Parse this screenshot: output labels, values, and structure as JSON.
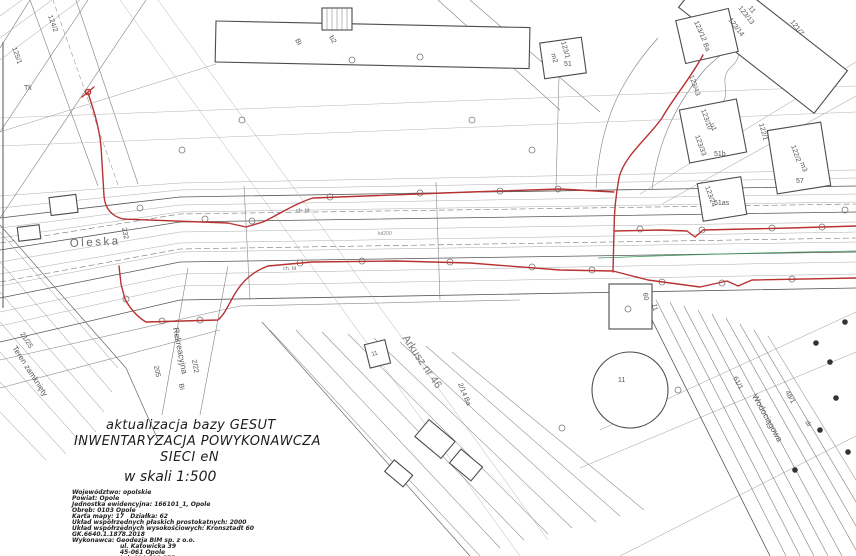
{
  "colors": {
    "red": "#b83232",
    "green": "#3f9960",
    "line_light": "#ababab",
    "line_mid": "#7d7d7d",
    "line_dark": "#4c4c4c",
    "text": "#555555"
  },
  "title_block": {
    "line1": "aktualizacja bazy GESUT",
    "line2": "INWENTARYZACJA POWYKONAWCZA",
    "line3": "SIECI eN",
    "scale": "w skali 1:500",
    "details": [
      "Województwo: opolskie",
      "Powiat: Opole",
      "Jednostka ewidencyjna: 166101_1, Opole",
      "Obręb: 0103 Opole",
      "Karta mapy: 17   Działka: 62",
      "Układ współrzędnych płaskich prostokątnych: 2000",
      "Układ współrzędnych wysokościowych: Kronsztadt 60",
      "GK.6640.1.1878.2018",
      "Wykonawca: Geodezja BIM sp. z o.o.",
      "ul. Katowicka 39",
      "45-061 Opole",
      "tel. 604 090 875"
    ]
  },
  "map": {
    "streets": {
      "oleska": "Oleska",
      "rekreacyjna": "Rekreacyjna",
      "wodociagowa": "Wodociągowa",
      "teren_zamkniety": "Teren zamknięty",
      "arkusz": "Arkusz nr 46"
    },
    "parcels": {
      "p124_2": "124/2",
      "p125_1": "125/1",
      "tk": "Tk",
      "n232": "232",
      "n205": "205",
      "p2_22": "2/22",
      "bi_a": "Bi",
      "p2_14": "2/14",
      "ba_b": "Ba",
      "p21_25": "21/25",
      "p123_1": "123/1",
      "m2": "m2",
      "n51": "51",
      "bi_b": "Bi",
      "b2": "b2",
      "p123_12": "123/12",
      "ba_a": "Ba",
      "p123_13": "123/13",
      "p123_14": "123/14",
      "p121_7": "121/7",
      "n11_top": "11",
      "p123_43": "123/43",
      "p123_10": "123/10",
      "u1": "u1",
      "p123_33": "123/33",
      "n51b": "51b",
      "p122_1": "122/1",
      "p122_2": "122/2",
      "m3": "m3",
      "n57": "57",
      "p123_24": "123/24",
      "n51as": "51as",
      "n60": "60",
      "n11_sq": "11",
      "n11_circle": "11",
      "n11_rect": "11",
      "p61_1": "61/1",
      "p48_1": "48/1",
      "dr": "dr",
      "ch_bl": "ch. bl",
      "ch_bl2": "ch. bł",
      "kd200": "kd200"
    }
  }
}
